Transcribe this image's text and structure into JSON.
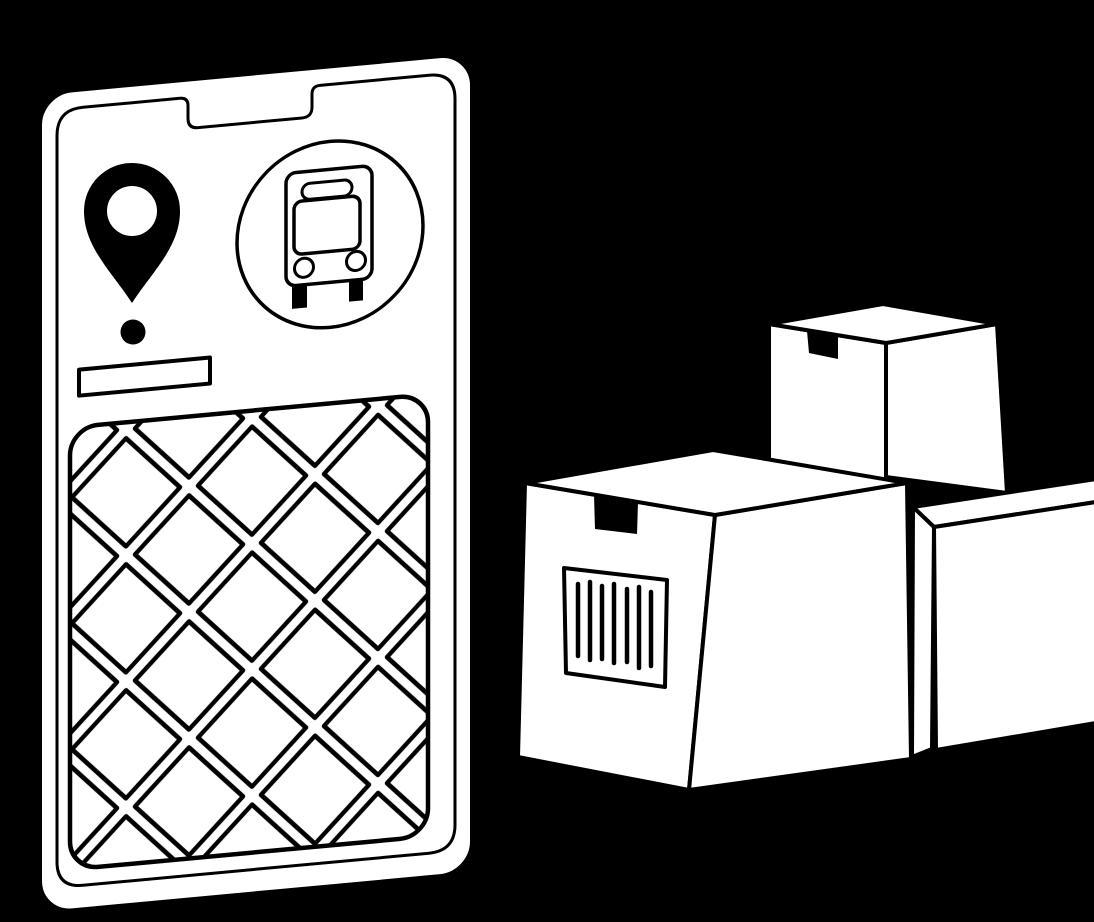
{
  "scene": {
    "description": "Black-and-white line-art illustration of a smartphone running a transit/delivery map app beside a stack of shipping boxes",
    "background_color": "#000000",
    "line_color": "#000000",
    "surface_color": "#ffffff",
    "tape_color": "#000000"
  },
  "phone": {
    "tilt_degrees": -5.3,
    "screen_elements": [
      "location-pin",
      "bus-stop-badge",
      "address-label-bar",
      "street-map"
    ],
    "map": {
      "pattern": "diagonal street grid of diamond city blocks",
      "block_pitch_px": 126,
      "street_width_px": 13
    }
  },
  "bus_badge": {
    "shape": "circle",
    "icon": "front view of a bus with destination sign, windshield, two lights and two wheels"
  },
  "boxes": {
    "count": 3,
    "arrangement": [
      "tall box at back",
      "large box in front with barcode label",
      "box at right edge, partially cropped"
    ],
    "tape_tabs": 2,
    "barcode": {
      "bar_count": 7
    }
  }
}
